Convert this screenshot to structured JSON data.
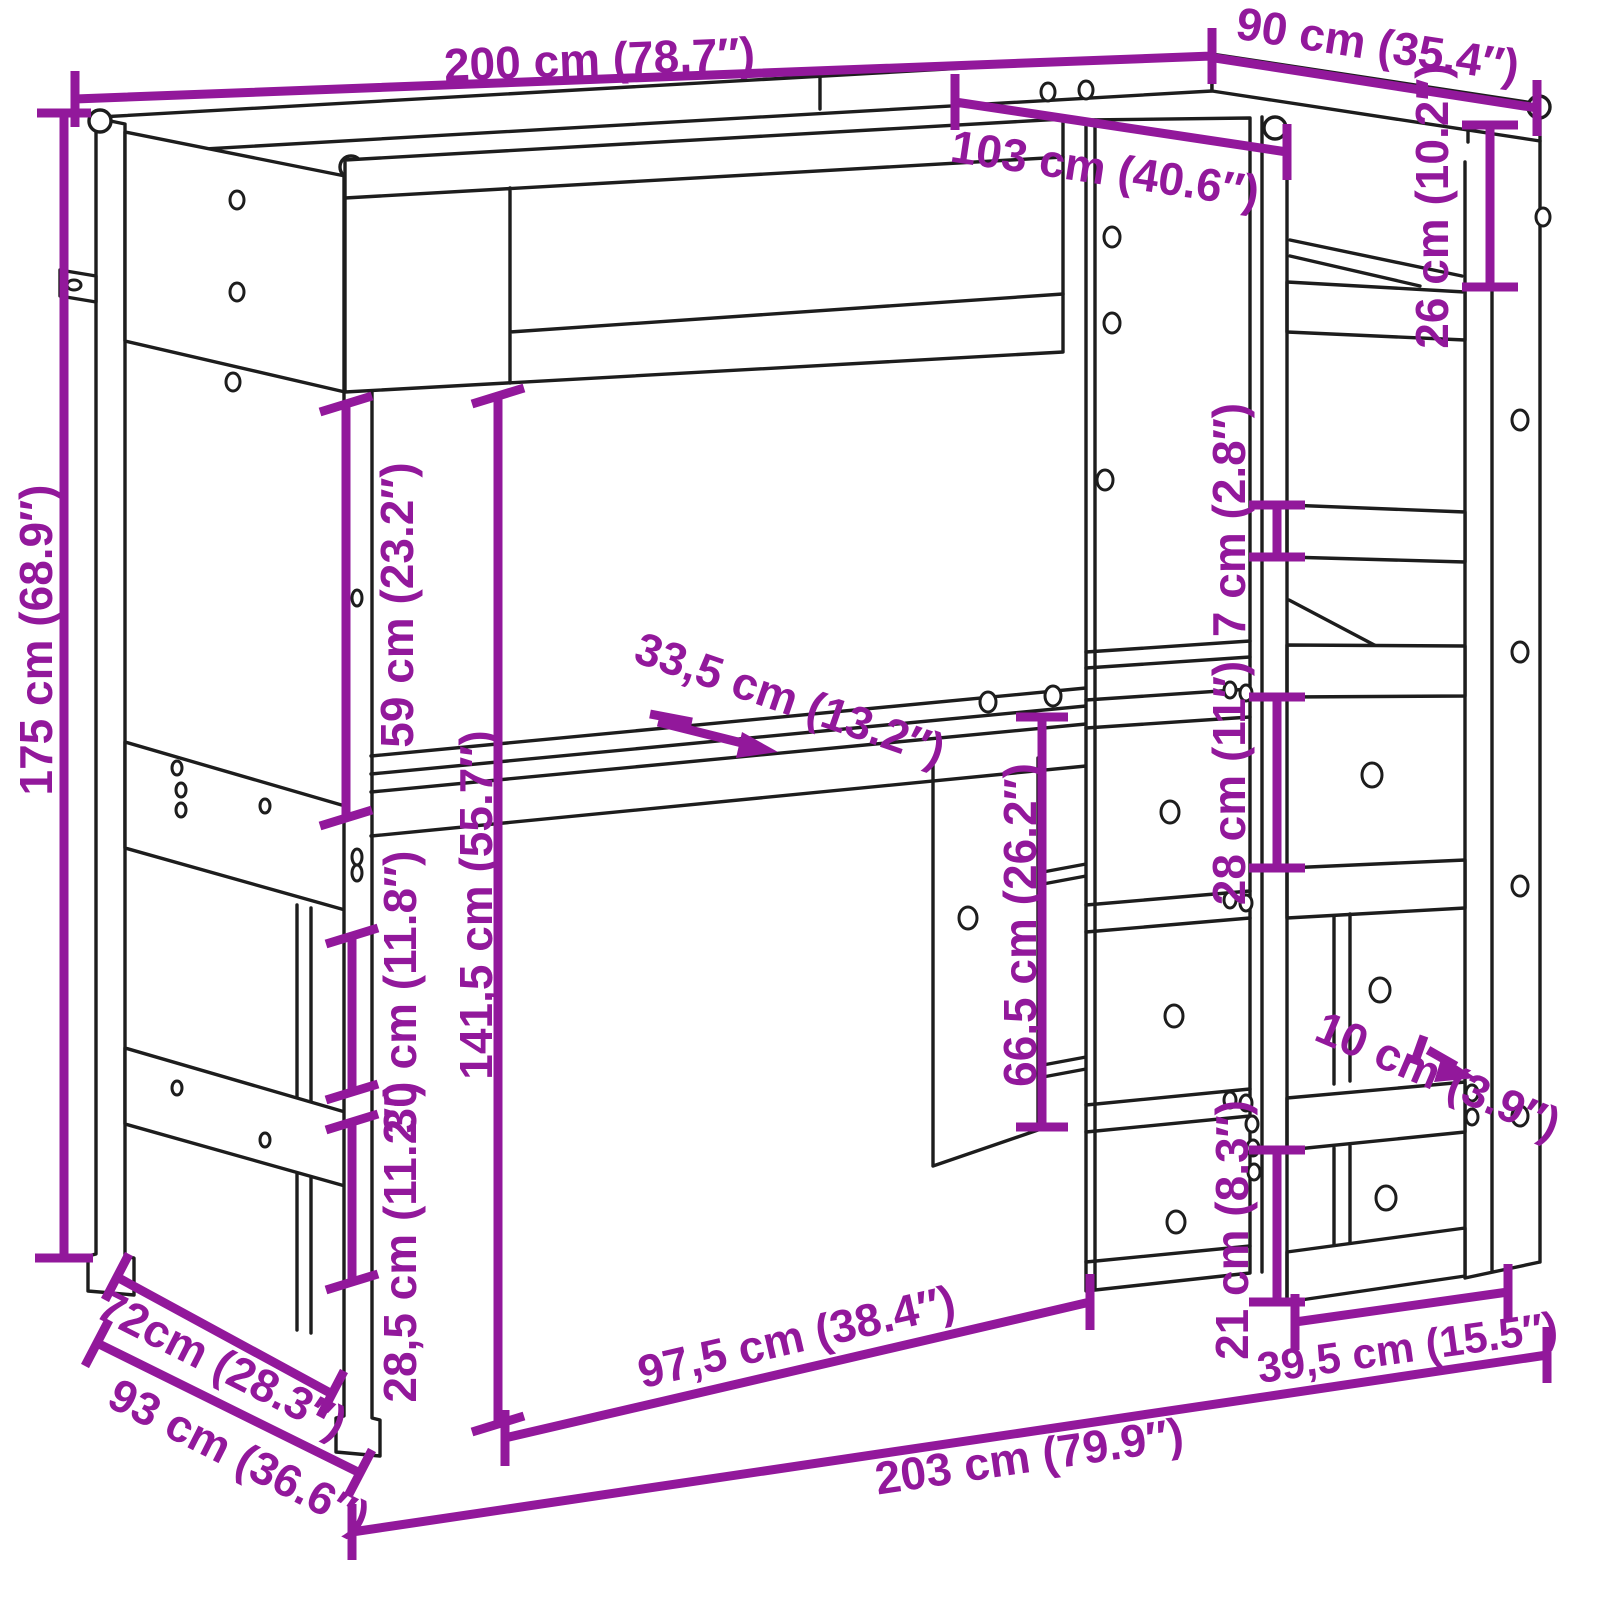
{
  "figure": {
    "accent_color": "#92189b",
    "line_color": "#1d1d1d",
    "background": "#ffffff"
  },
  "dims": {
    "top_width": "200 cm (78.7″)",
    "top_depth": "90 cm (35.4″)",
    "inner_width": "103 cm (40.6″)",
    "gap_26": "26 cm (10.2″)",
    "thickness_7": "7 cm (2.8″)",
    "gap_28": "28 cm (11″)",
    "height_total": "175 cm (68.9″)",
    "gap_59": "59 cm (23.2″)",
    "clearance_141_5": "141,5 cm (55.7″)",
    "desk_depth_33_5": "33,5 cm (13.2″)",
    "under_desk_66_5": "66,5 cm (26.2″)",
    "gap_30": "30 cm (11.8″)",
    "gap_28_5": "28,5 cm (11.2″)",
    "depth_72": "72cm (28.3″)",
    "depth_93": "93 cm (36.6″)",
    "clearance_97_5": "97,5 cm (38.4″)",
    "total_width_203": "203 cm (79.9″)",
    "shelf_width_39_5": "39,5 cm (15.5″)",
    "gap_21": "21 cm (8.3″)",
    "shelf_depth_10": "10 cm (3.9″)"
  }
}
